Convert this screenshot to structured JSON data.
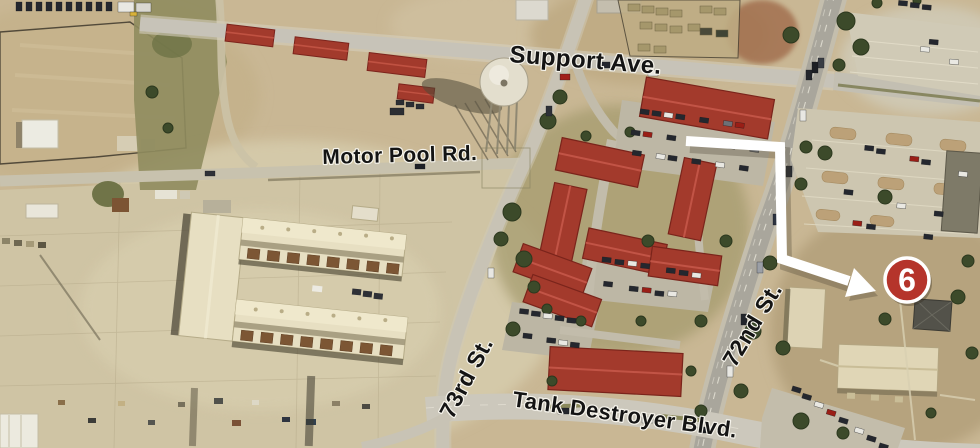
{
  "map": {
    "kind": "aerial-photo-map",
    "labels": {
      "support_ave": "Support Ave.",
      "motor_pool_rd": "Motor Pool Rd.",
      "street_73rd": "73rd St.",
      "street_72nd": "72nd St.",
      "tank_destroyer_blvd": "Tank Destroyer Blvd."
    },
    "marker": {
      "number": "6",
      "fill": "#b5342b",
      "ring": "#ffffff"
    },
    "arrow": {
      "color": "#ffffff"
    },
    "palette": {
      "label_text": "#141414",
      "label_halo": "#f6f4ec",
      "terrain": "#c9b794",
      "red_roof": "#a33a2c"
    }
  }
}
